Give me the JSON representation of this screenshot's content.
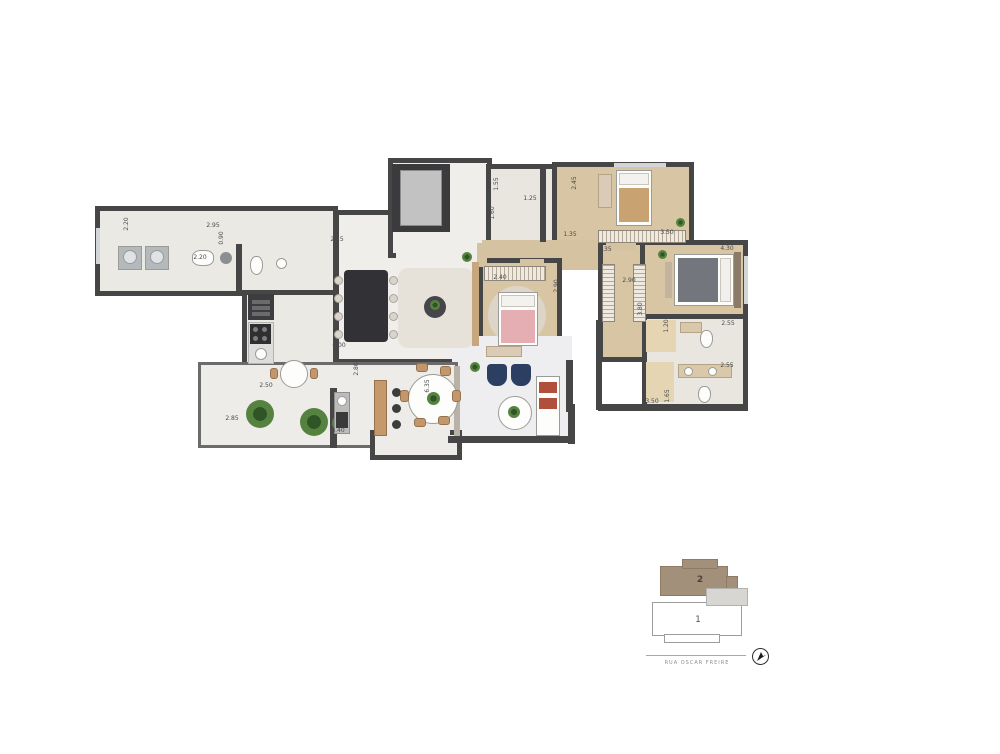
{
  "colors": {
    "wall": "#464646",
    "wood": "#d8c5a4",
    "tile": "#ebe9e4",
    "marble": "#efeeea",
    "bath": "#e9e6e0",
    "terrace": "#edece8",
    "bed-blanket-pink": "#e5aeb3",
    "bed-blanket-grey": "#73767c",
    "armchair-blue": "#2d3e63",
    "unit2": "#a2907b"
  },
  "floorplan": {
    "dimensions": [
      {
        "text": "2.20",
        "x": 127,
        "y": 224,
        "vertical": true
      },
      {
        "text": "2.95",
        "x": 213,
        "y": 226,
        "vertical": false
      },
      {
        "text": "0.90",
        "x": 222,
        "y": 238,
        "vertical": true
      },
      {
        "text": "2.20",
        "x": 200,
        "y": 258,
        "vertical": false
      },
      {
        "text": "2.15",
        "x": 337,
        "y": 240,
        "vertical": false
      },
      {
        "text": "4.00",
        "x": 338,
        "y": 258,
        "vertical": true
      },
      {
        "text": "1.55",
        "x": 497,
        "y": 184,
        "vertical": true
      },
      {
        "text": "1.60",
        "x": 493,
        "y": 213,
        "vertical": true
      },
      {
        "text": "1.25",
        "x": 530,
        "y": 199,
        "vertical": false
      },
      {
        "text": "2.45",
        "x": 575,
        "y": 183,
        "vertical": true
      },
      {
        "text": "1.35",
        "x": 570,
        "y": 235,
        "vertical": false
      },
      {
        "text": "3.35",
        "x": 605,
        "y": 250,
        "vertical": false
      },
      {
        "text": "3.50",
        "x": 667,
        "y": 233,
        "vertical": false
      },
      {
        "text": "4.30",
        "x": 727,
        "y": 249,
        "vertical": false
      },
      {
        "text": "2.90",
        "x": 629,
        "y": 281,
        "vertical": false
      },
      {
        "text": "3.80",
        "x": 641,
        "y": 309,
        "vertical": true
      },
      {
        "text": "2.40",
        "x": 500,
        "y": 278,
        "vertical": false
      },
      {
        "text": "2.90",
        "x": 557,
        "y": 286,
        "vertical": true
      },
      {
        "text": "2.55",
        "x": 728,
        "y": 324,
        "vertical": false
      },
      {
        "text": "1.20",
        "x": 667,
        "y": 326,
        "vertical": true
      },
      {
        "text": "2.55",
        "x": 727,
        "y": 366,
        "vertical": false
      },
      {
        "text": "1.65",
        "x": 668,
        "y": 396,
        "vertical": true
      },
      {
        "text": "3.50",
        "x": 652,
        "y": 402,
        "vertical": false
      },
      {
        "text": "6.00",
        "x": 339,
        "y": 346,
        "vertical": false
      },
      {
        "text": "2.50",
        "x": 266,
        "y": 386,
        "vertical": false
      },
      {
        "text": "2.85",
        "x": 232,
        "y": 419,
        "vertical": false
      },
      {
        "text": "2.80",
        "x": 357,
        "y": 369,
        "vertical": true
      },
      {
        "text": "6.40",
        "x": 338,
        "y": 431,
        "vertical": false
      },
      {
        "text": "6.35",
        "x": 428,
        "y": 386,
        "vertical": true
      }
    ]
  },
  "keyplan": {
    "unit_top_label": "2",
    "unit_bottom_label": "1",
    "street_label": "RUA OSCAR FREIRE"
  }
}
